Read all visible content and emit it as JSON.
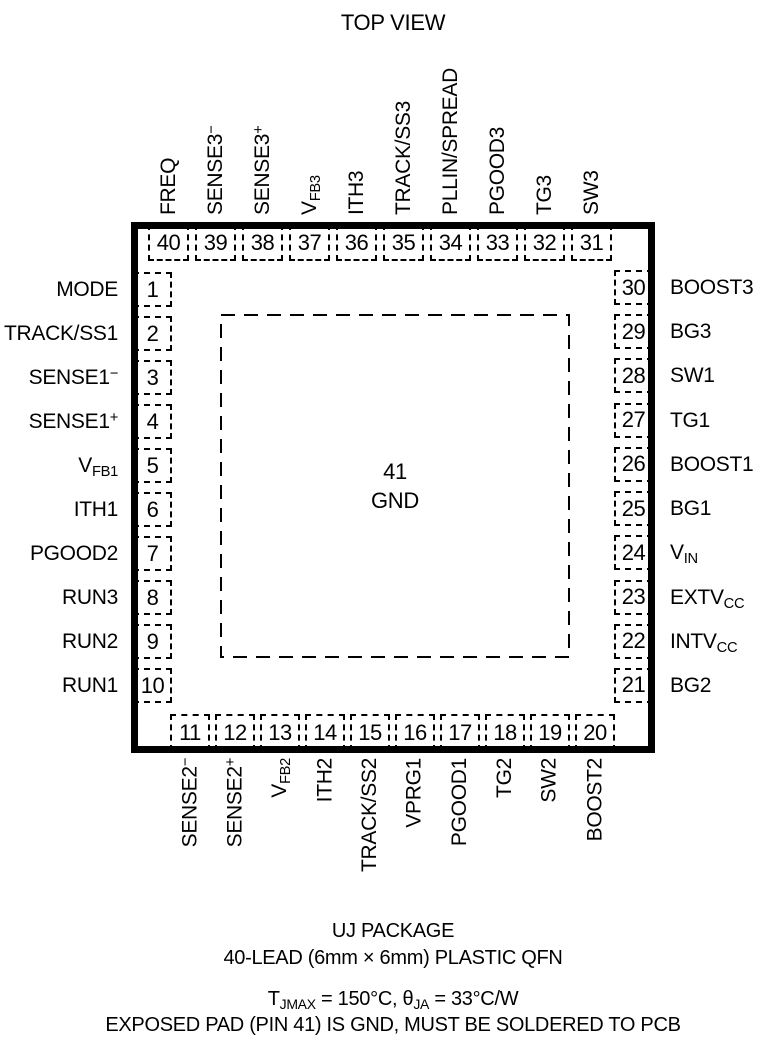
{
  "title": "TOP VIEW",
  "chip": {
    "center_pad": {
      "pin": "41",
      "label": "GND"
    },
    "top_pins": [
      {
        "pin": "40",
        "label": "FREQ"
      },
      {
        "pin": "39",
        "label": "SENSE3^{−}"
      },
      {
        "pin": "38",
        "label": "SENSE3^{+}"
      },
      {
        "pin": "37",
        "label": "V_{FB3}"
      },
      {
        "pin": "36",
        "label": "ITH3"
      },
      {
        "pin": "35",
        "label": "TRACK/SS3"
      },
      {
        "pin": "34",
        "label": "PLLIN/SPREAD"
      },
      {
        "pin": "33",
        "label": "PGOOD3"
      },
      {
        "pin": "32",
        "label": "TG3"
      },
      {
        "pin": "31",
        "label": "SW3"
      }
    ],
    "left_pins": [
      {
        "pin": "1",
        "label": "MODE"
      },
      {
        "pin": "2",
        "label": "TRACK/SS1"
      },
      {
        "pin": "3",
        "label": "SENSE1^{−}"
      },
      {
        "pin": "4",
        "label": "SENSE1^{+}"
      },
      {
        "pin": "5",
        "label": "V_{FB1}"
      },
      {
        "pin": "6",
        "label": "ITH1"
      },
      {
        "pin": "7",
        "label": "PGOOD2"
      },
      {
        "pin": "8",
        "label": "RUN3"
      },
      {
        "pin": "9",
        "label": "RUN2"
      },
      {
        "pin": "10",
        "label": "RUN1"
      }
    ],
    "right_pins": [
      {
        "pin": "30",
        "label": "BOOST3"
      },
      {
        "pin": "29",
        "label": "BG3"
      },
      {
        "pin": "28",
        "label": "SW1"
      },
      {
        "pin": "27",
        "label": "TG1"
      },
      {
        "pin": "26",
        "label": "BOOST1"
      },
      {
        "pin": "25",
        "label": "BG1"
      },
      {
        "pin": "24",
        "label": "V_{IN}"
      },
      {
        "pin": "23",
        "label": "EXTV_{CC}"
      },
      {
        "pin": "22",
        "label": "INTV_{CC}"
      },
      {
        "pin": "21",
        "label": "BG2"
      }
    ],
    "bottom_pins": [
      {
        "pin": "11",
        "label": "SENSE2^{−}"
      },
      {
        "pin": "12",
        "label": "SENSE2^{+}"
      },
      {
        "pin": "13",
        "label": "V_{FB2}"
      },
      {
        "pin": "14",
        "label": "ITH2"
      },
      {
        "pin": "15",
        "label": "TRACK/SS2"
      },
      {
        "pin": "16",
        "label": "VPRG1"
      },
      {
        "pin": "17",
        "label": "PGOOD1"
      },
      {
        "pin": "18",
        "label": "TG2"
      },
      {
        "pin": "19",
        "label": "SW2"
      },
      {
        "pin": "20",
        "label": "BOOST2"
      }
    ]
  },
  "footer": {
    "line1": "UJ PACKAGE",
    "line2": "40-LEAD (6mm × 6mm) PLASTIC QFN",
    "line3": "T_{JMAX} = 150°C, θ_{JA} = 33°C/W",
    "line4": "EXPOSED PAD (PIN 41) IS GND, MUST BE SOLDERED TO PCB"
  },
  "colors": {
    "ink": "#000000",
    "background": "#ffffff"
  }
}
